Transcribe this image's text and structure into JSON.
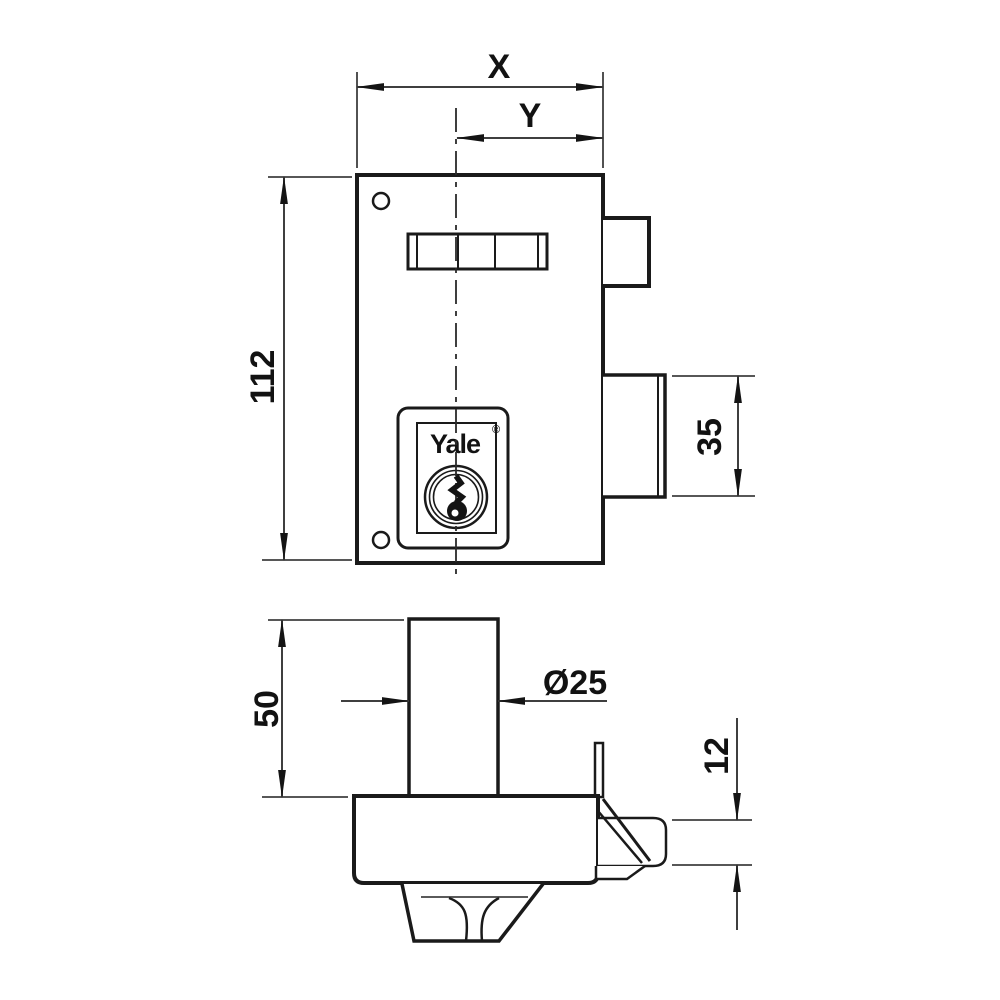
{
  "diagram": {
    "brand": {
      "name": "Yale",
      "registered_mark": "®"
    },
    "dimensions": {
      "overall_width": "X",
      "backset": "Y",
      "body_height": "112",
      "deadbolt_height": "35",
      "cylinder_height": "50",
      "cylinder_diameter": "Ø25",
      "latch_thickness": "12"
    },
    "colors": {
      "line": "#1a1a1a",
      "dimension_line": "#3f3f3f",
      "text": "#121212",
      "background": "#ffffff"
    }
  }
}
